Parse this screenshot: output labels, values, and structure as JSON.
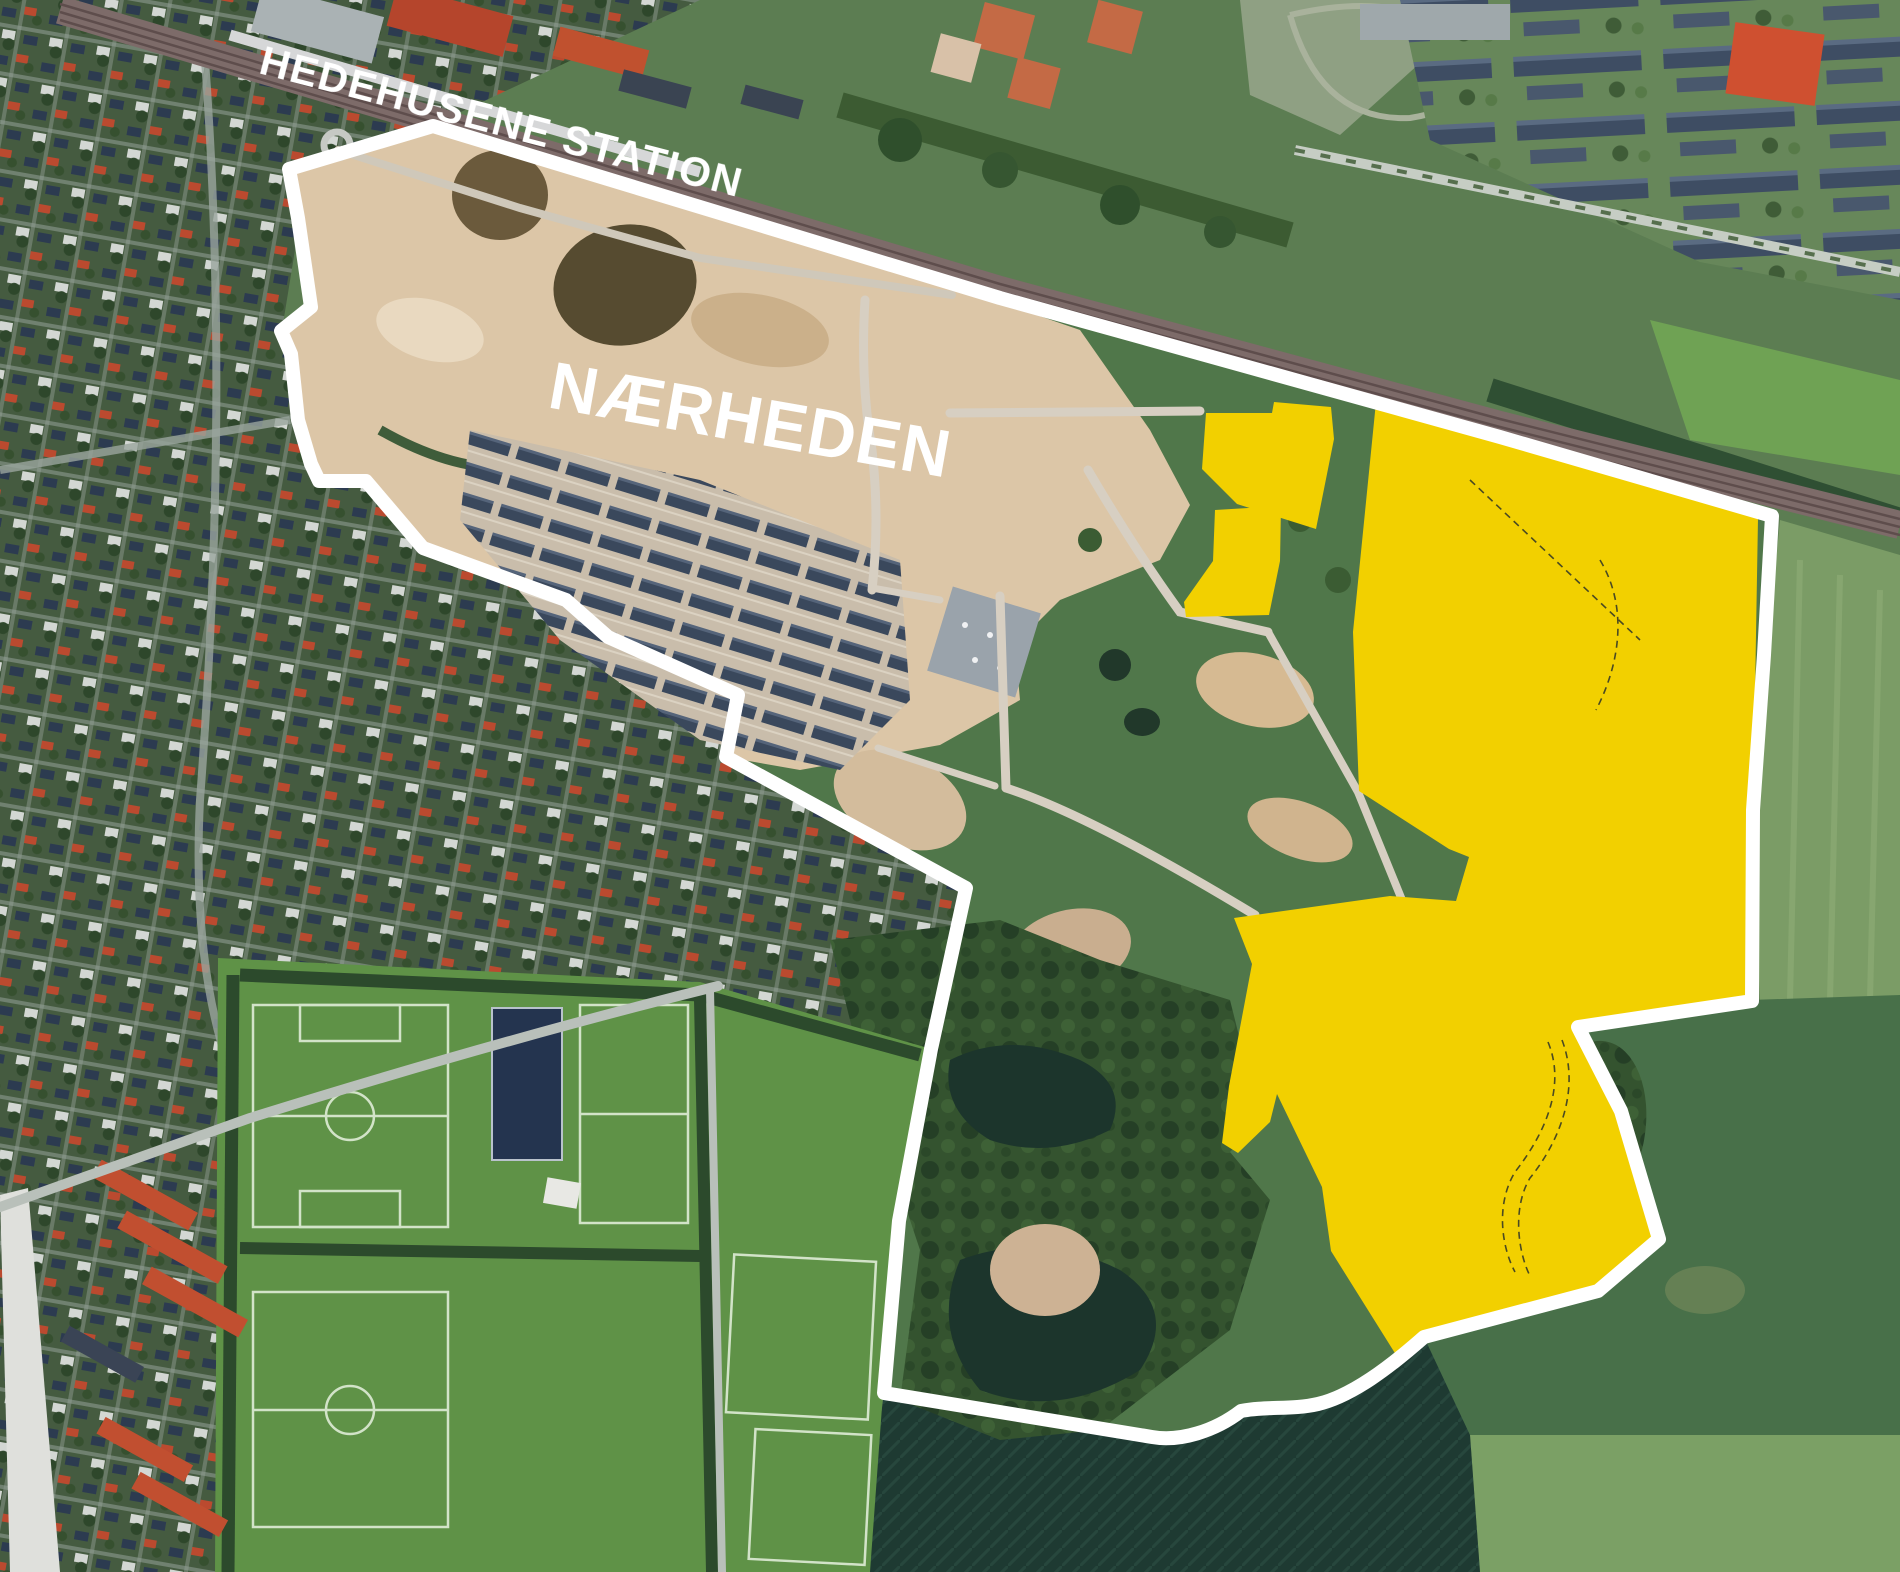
{
  "labels": {
    "station": "HEDEHUSENE STATION",
    "area": "NÆRHEDEN"
  },
  "colors": {
    "highlight_yellow": "#F2D000",
    "boundary_white": "#FFFFFF",
    "label_white": "#FFFFFF",
    "construction_tan": "#DCC6A7",
    "inside_green": "#50774A",
    "railway_brown": "#7D6B69",
    "dark_farm": "#1F3C33",
    "pitch_green": "#5F9247",
    "water_dark": "#1C352C"
  }
}
